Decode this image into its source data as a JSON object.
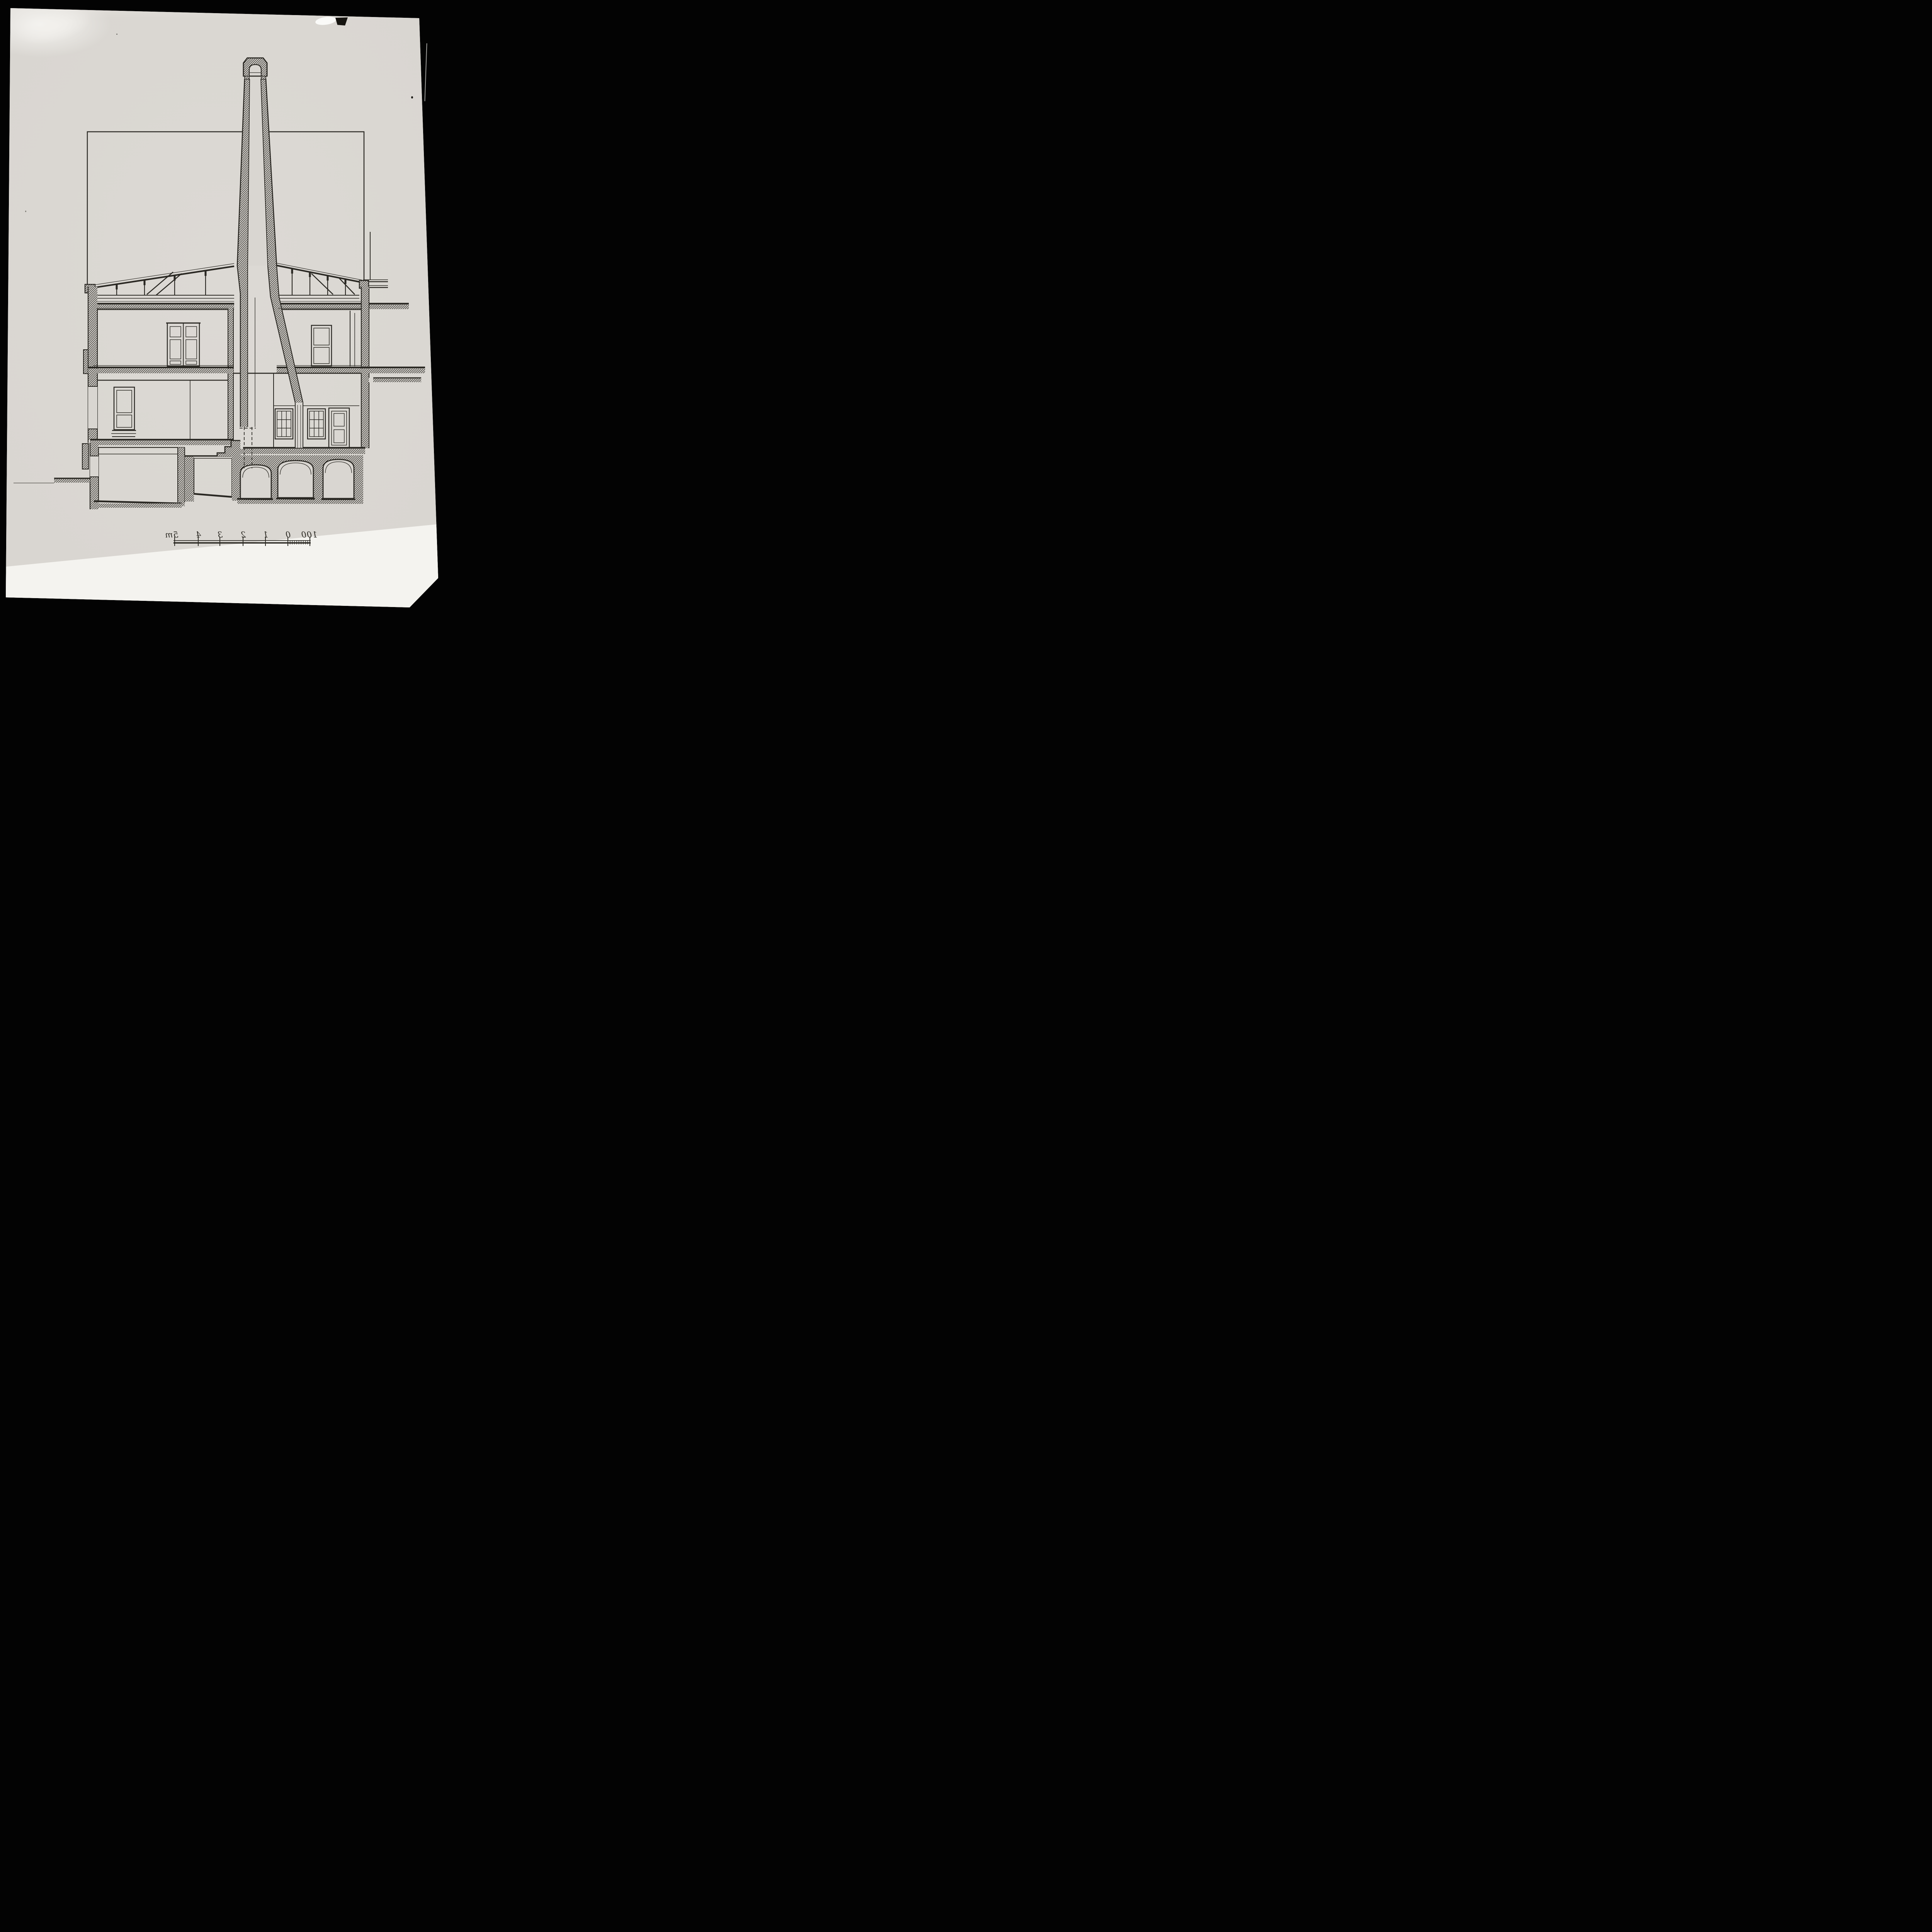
{
  "figure": {
    "type": "architectural-section-drawing",
    "description": "Black and white photograph of an ink cross-section drawing of a building with a tall tapering chimney, roof truss, two floors, basement vaults and a stepped chimney foundation",
    "mirrored_print": true
  },
  "scale_bar": {
    "unit": "m",
    "labels": [
      "5m",
      "4",
      "3",
      "2",
      "1",
      "0",
      "100"
    ],
    "mirrored": true,
    "major_divisions": 5,
    "minor_divisions_between_0_and_100": 10
  },
  "colors": {
    "background": "#030303",
    "paper": "#d9d6d1",
    "paper_bright_strip": "#f4f3ef",
    "ink": "#2a2823"
  }
}
